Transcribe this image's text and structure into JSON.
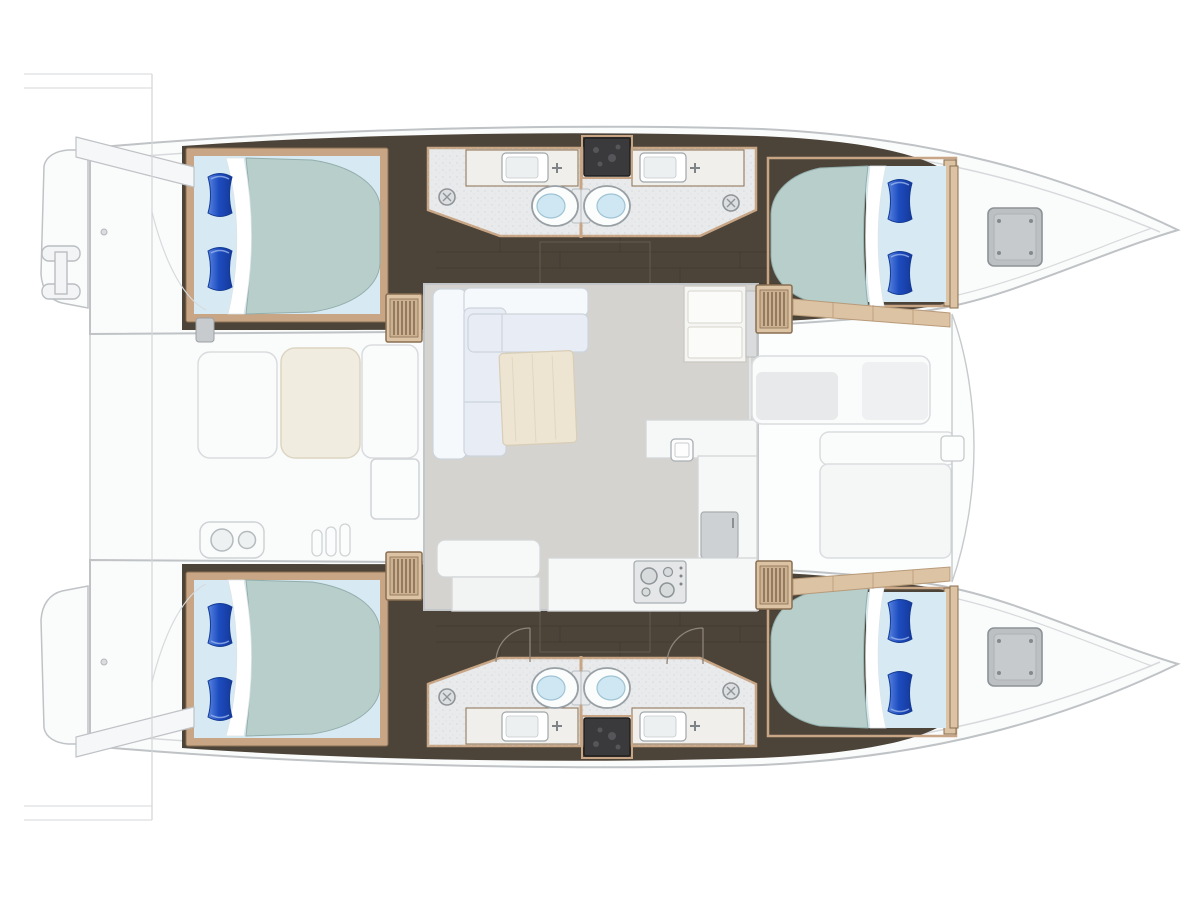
{
  "vessel": {
    "description": "Sailing catamaran floor plan, overhead view",
    "type": "catamaran",
    "view": "top-down layout",
    "cabins": 4,
    "bathrooms": 4,
    "berths": "4 double berths",
    "port_hull": {
      "aft_cabin": "double berth with two blue pillows",
      "bathrooms": "two back-to-back heads with sink, toilet and shower drain",
      "forward_cabin": "double berth with two blue pillows",
      "bow": "anchor locker with deck hatch",
      "stern": "swim platform with boarding ladder"
    },
    "starboard_hull": {
      "aft_cabin": "double berth with two blue pillows",
      "bathrooms": "two back-to-back heads with sink, toilet and shower drain",
      "forward_cabin": "double berth with two blue pillows",
      "bow": "anchor locker with deck hatch",
      "stern": "swim platform"
    },
    "bridgedeck": {
      "salon": [
        "L-shaped sofa",
        "coffee table",
        "galley island with sink",
        "refrigerator cabinet",
        "stove",
        "aft galley counter",
        "companionway steps x4"
      ],
      "aft_cockpit": [
        "bench seat",
        "cockpit table",
        "side bench",
        "storage box",
        "wet-bar sink",
        "transom steps"
      ],
      "forward_cockpit": [
        "lounge bench with cushions",
        "sun bench",
        "bow step pad"
      ]
    }
  },
  "palette": {
    "bg": "#ffffff",
    "hull-fill": "#fafbfb",
    "hull-stroke": "#bfc3c6",
    "deck-line": "#d7dadc",
    "floor-dark": "#4c4339",
    "plank": "#3c342b",
    "shadow-dark": "#2d2722",
    "wood": "#c7a585",
    "wood-light": "#dcc3a4",
    "wood-dark": "#8a6f52",
    "bath-floor": "#e9eaeb",
    "counter": "#f0efeb",
    "panel-dark": "#3a393b",
    "toilet-lid": "#cfe7f3",
    "bed-sheet": "#d7eaf4",
    "bed-duvet": "#b7cecb",
    "duvet-stroke": "#93aeab",
    "salon-floor": "#d5d3cf",
    "sofa-light": "#f6f9fc",
    "sofa-mid": "#e8edf5",
    "sofa-stroke": "#ccd4dc",
    "table-wood": "#ede4d2",
    "cockpit-table": "#f1ece0",
    "hatch": "#bcc0c2",
    "hatch-stroke": "#8d9296",
    "pillow-dark": "#1d4cc0",
    "pillow-light": "#5a85e0"
  }
}
